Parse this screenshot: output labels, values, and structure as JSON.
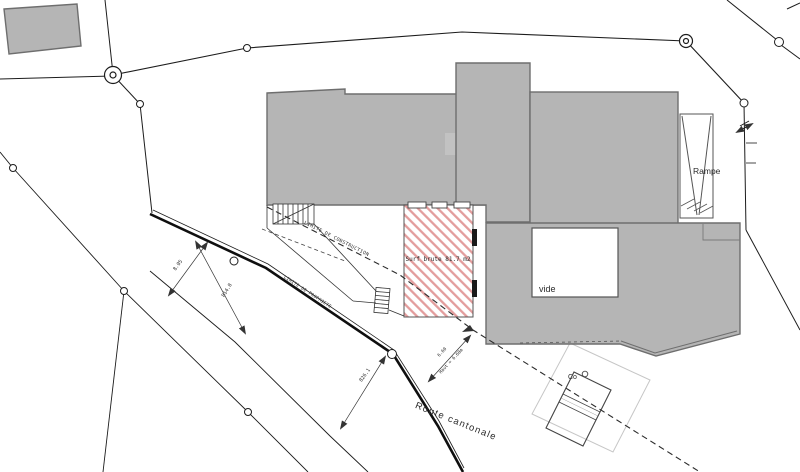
{
  "plan": {
    "labels": {
      "surface": "Surf brute 81.7 m2",
      "vide": "vide",
      "rampe": "Rampe",
      "co": "Co",
      "route_cantonale": "Route cantonale",
      "limite_construction": "LIMITE DE CONSTRUCTION",
      "limite_propriete": "LIMITE DE PROPRIETE"
    },
    "dimensions": {
      "road_width": "8.05",
      "spot_1": "814.8",
      "spot_2": "826.1",
      "height_value": "6.60",
      "height_label": "Haut = 6.60m"
    },
    "colors": {
      "building_fill": "#b5b5b5",
      "building_stroke": "#6e6e6e",
      "hatch_pink": "#e39c9c",
      "line_dark": "#1c1c1c",
      "line_light": "#c6c6c6"
    }
  }
}
